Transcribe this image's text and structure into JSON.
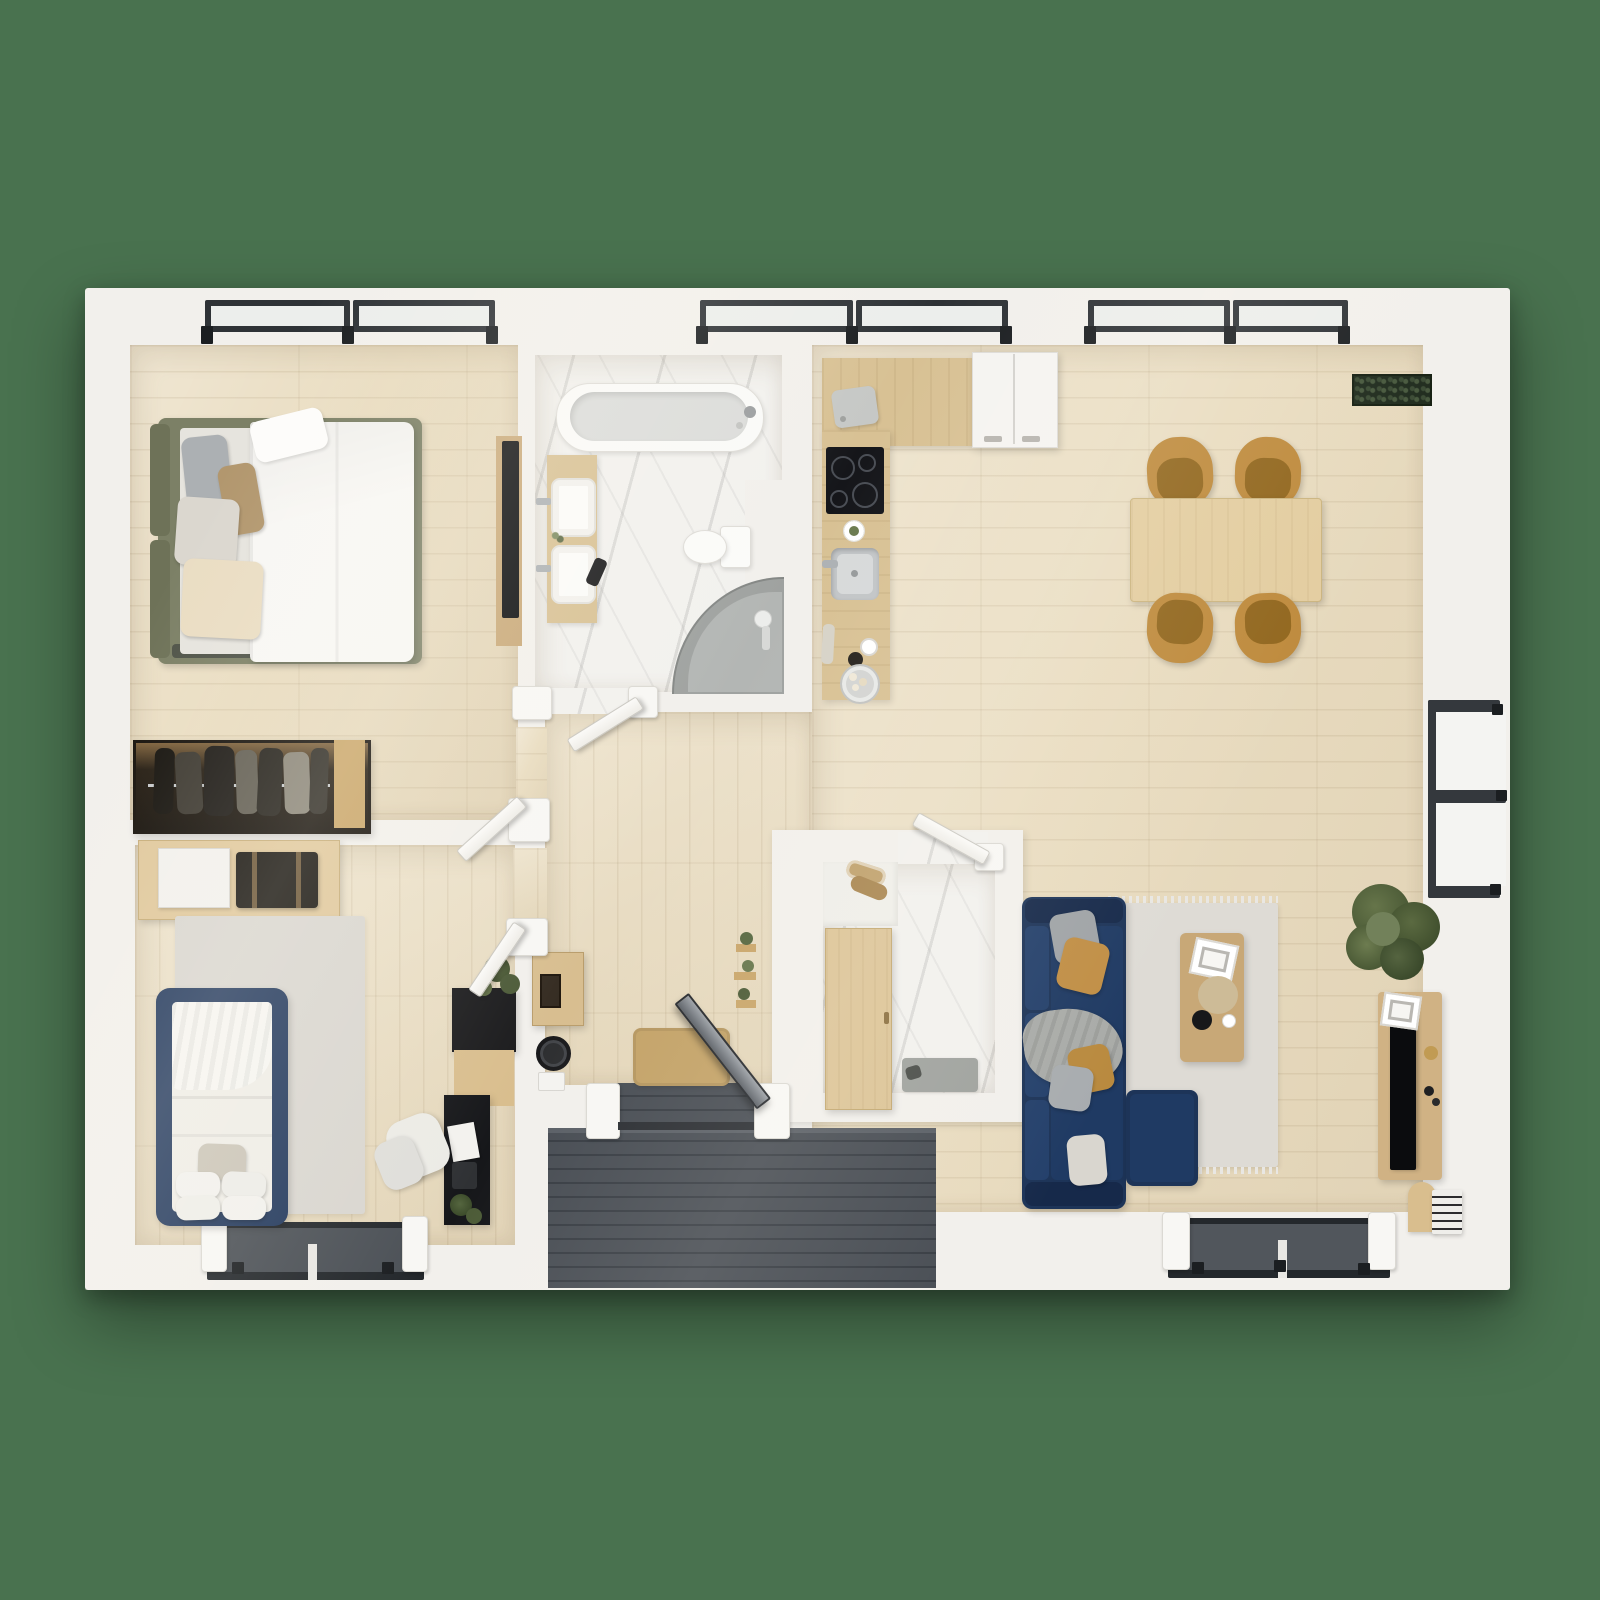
{
  "scene": {
    "type": "3d-floor-plan-top-down-render",
    "subject": "two-bedroom apartment",
    "view": "orthographic top view, furnished, no text labels"
  },
  "palette": {
    "bg": "#49724F",
    "wall": "#F2F0EC",
    "wood": "#E9DCC0",
    "marble": "#F2F1EE",
    "deck": "#40454C",
    "counter": "#D8C194",
    "cabinet": "#DCC497",
    "table": "#E3CDA0",
    "console": "#D0B284",
    "coffee": "#C8A877",
    "ochre": "#BE8A3C",
    "ochreSeat": "#91661D",
    "navy": "#1D3458",
    "navyDark": "#16294A",
    "navyCushion": "#24406B",
    "olive": "#7C8066",
    "oliveDark": "#6E7258",
    "bedNavy": "#243A5E",
    "rug": "#DEDBD5",
    "rugWarm": "#D9D6D0",
    "duvet": "#F8F7F4",
    "black": "#0B0C0E",
    "frame": "#2E3236",
    "glass": "#ECEEEC",
    "doorWhite": "#F9F8F5",
    "doorMetal": "#80858C",
    "mat": "#C3A267",
    "green": "#55663F",
    "greenDark": "#3F4D2C",
    "towel": "#BFA06B",
    "wardrobe": "#221A10",
    "glow": "#B9894E",
    "steel": "#ADB1B4"
  },
  "rooms": [
    {
      "name": "bedroom-1",
      "floor": "light-oak",
      "furniture": [
        "double-bed-olive-frame",
        "white-duvet",
        "gray-pillow",
        "tan-pillow",
        "white-pillow",
        "cream-pillow",
        "wall-mounted-tv",
        "open-wardrobe-with-clothes"
      ]
    },
    {
      "name": "bathroom-1",
      "floor": "white-marble",
      "furniture": [
        "bathtub",
        "double-vanity",
        "two-vessel-sinks",
        "toilet",
        "corner-shower-tray",
        "hair-dryer"
      ]
    },
    {
      "name": "kitchen",
      "floor": "light-oak",
      "furniture": [
        "l-shaped-counter",
        "fridge",
        "induction-cooktop",
        "kitchen-sink",
        "cutting-board",
        "green-dish",
        "coffee-cup",
        "grinder",
        "pastry-plate",
        "bottle"
      ]
    },
    {
      "name": "dining-area",
      "floor": "light-oak",
      "furniture": [
        "wooden-dining-table",
        "ochre-chair",
        "ochre-chair",
        "ochre-chair",
        "ochre-chair",
        "dark-planter-box"
      ]
    },
    {
      "name": "living-room",
      "floor": "light-oak",
      "furniture": [
        "navy-sectional-sofa",
        "throw-pillows",
        "gray-blanket",
        "area-rug",
        "coffee-table",
        "picture-book",
        "flower-bouquet",
        "black-bowl",
        "tv-console",
        "flat-tv",
        "indoor-plant",
        "magazine-arch",
        "book-stack"
      ]
    },
    {
      "name": "hallway",
      "floor": "light-oak",
      "furniture": [
        "wall-cabinet",
        "round-wall-fan",
        "white-intercom-box",
        "tan-doormat",
        "plant-wall-shelves"
      ]
    },
    {
      "name": "bathroom-2",
      "floor": "white-marble",
      "furniture": [
        "tall-wood-cabinet",
        "white-counter",
        "rolled-towels",
        "gray-bath-mat"
      ]
    },
    {
      "name": "bedroom-2",
      "floor": "light-oak",
      "furniture": [
        "navy-single-bed",
        "white-duvet",
        "pillow-set",
        "gray-area-rug",
        "storage-console",
        "white-storage-box",
        "black-suitcase",
        "desk-hutch",
        "black-desk",
        "office-chair",
        "desk-plants"
      ]
    },
    {
      "name": "entry",
      "floor": "dark-decking",
      "furniture": [
        "metal-front-door",
        "deck-planks"
      ]
    }
  ],
  "openings": {
    "windows": [
      "top-bedroom-1-left",
      "top-bedroom-1-right",
      "top-kitchen-left",
      "top-kitchen-right",
      "top-dining-left",
      "top-dining-right",
      "right-wall-tall-window",
      "bottom-living-bay",
      "bottom-bedroom-2-bay"
    ],
    "doors": [
      "bedroom-1-door-open",
      "bedroom-2-door-open",
      "bathroom-1-door-open",
      "bathroom-2-door-open",
      "front-door-open"
    ]
  }
}
